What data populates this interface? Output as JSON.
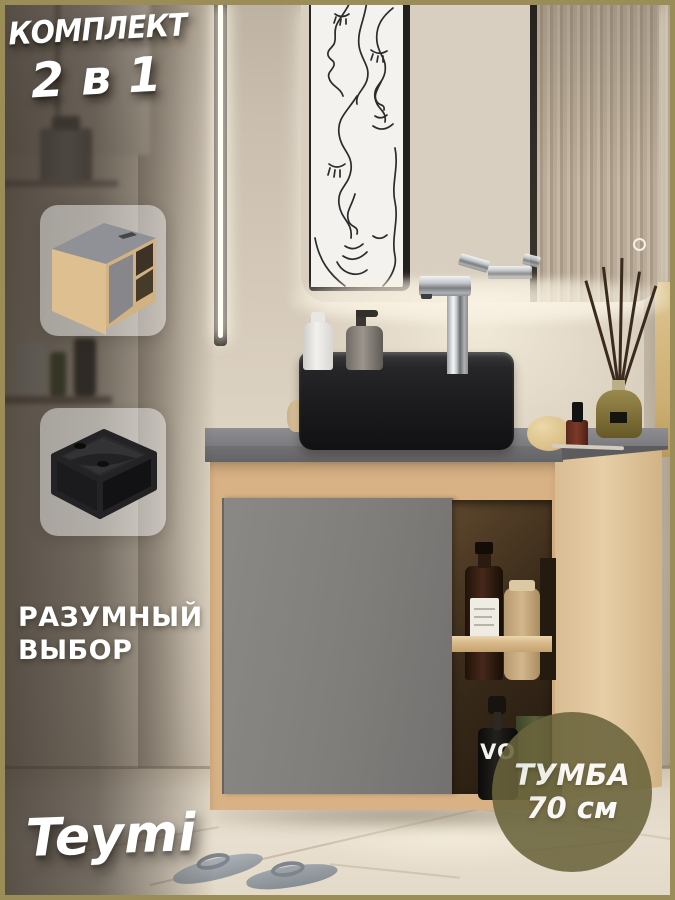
{
  "promo": {
    "headline_line1": "КОМПЛЕКТ",
    "headline_line2": "2 в 1",
    "tagline_line1": "РАЗУМНЫЙ",
    "tagline_line2": "ВЫБОР",
    "brand": "Teymi"
  },
  "badge": {
    "line1": "ТУМБА",
    "line2": "70 см"
  },
  "scene": {
    "dropper_label": "VO"
  },
  "colors": {
    "frame-olive": "#9a8d58",
    "badge-olive": "#6a643c",
    "wood": "#d8b184",
    "wood-light": "#e2c79d",
    "door-grey": "#827f7c",
    "counter-grey": "#7b7b7e",
    "sink-black": "#1b1b1d",
    "wall-beige": "#d6cbba",
    "glow": "#f9f2e2"
  }
}
